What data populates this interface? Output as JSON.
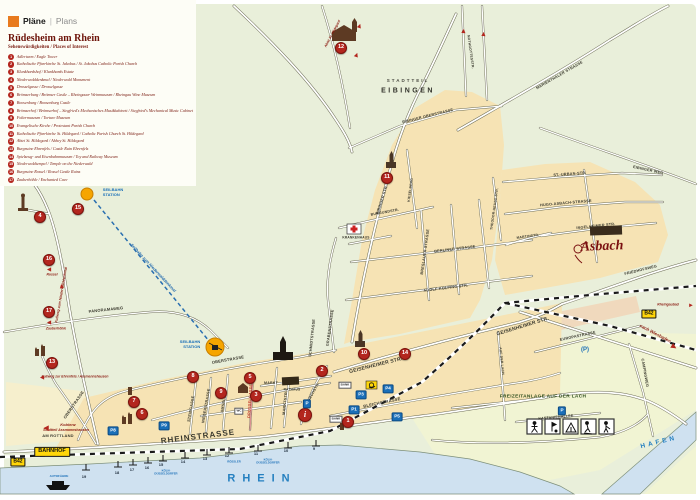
{
  "header": {
    "brand_de": "Pläne",
    "sep": "|",
    "brand_en": "Plans"
  },
  "legend": {
    "title": "Rüdesheim am Rhein",
    "subtitle": "Sehenswürdigkeiten / Places of Interest",
    "items": [
      {
        "num": "1",
        "label": "Adlerturm / Eagle Tower"
      },
      {
        "num": "2",
        "label": "Katholische Pfarrkirche St. Jakobus / St. Jakobus Catholic Parish Church"
      },
      {
        "num": "3",
        "label": "Klunkhardshof / Klunkhards Estate"
      },
      {
        "num": "4",
        "label": "Niederwalddenkmal / Niederwald Monument"
      },
      {
        "num": "5",
        "label": "Drosselgasse / Drosselgasse"
      },
      {
        "num": "6",
        "label": "Brömserburg / Brömser Castle – Rheingauer Weinmuseum / Rheingau Wine Museum"
      },
      {
        "num": "7",
        "label": "Boosenburg / Boosenburg Castle"
      },
      {
        "num": "8",
        "label": "Brömserhof / Brömserhof – Siegfried's Mechanisches Musikkabinett / Siegfried's Mechanical Music Cabinet"
      },
      {
        "num": "9",
        "label": "Foltermuseum / Torture Museum"
      },
      {
        "num": "10",
        "label": "Evangelische Kirche / Protestant Parish Church"
      },
      {
        "num": "11",
        "label": "Katholische Pfarrkirche St. Hildegard / Catholic Parish Church St. Hildegard"
      },
      {
        "num": "12",
        "label": "Abtei St. Hildegard / Abbey St. Hildegard"
      },
      {
        "num": "13",
        "label": "Burgruine Ehrenfels / Castle Ruin Ehrenfels"
      },
      {
        "num": "14",
        "label": "Spielzeug- und Eisenbahnmuseum / Toy and Railway Museum"
      },
      {
        "num": "15",
        "label": "Niederwaldtempel / Temple on the Niederwald"
      },
      {
        "num": "16",
        "label": "Burgruine Rossel / Rossel Castle Ruins"
      },
      {
        "num": "17",
        "label": "Zauberhöhle / Enchanted Cave"
      }
    ]
  },
  "map": {
    "district": {
      "line1": "STADTTEIL",
      "line2": "EIBINGEN"
    },
    "water": {
      "rhein": "RHEIN",
      "hafen": "HAFEN",
      "autofaehre": "AUTOFÄHRE"
    },
    "stations": {
      "seilbahn": "SEILBAHN\nSTATION"
    },
    "badges": {
      "bahnhof": "BAHNHOF",
      "b42": "B42",
      "markt": "MARKT",
      "rathaus": "RATHAUS",
      "krankenhaus": "KRANKENHAUS",
      "bank": "BANK",
      "wc": "WC",
      "asbach": "Asbach"
    },
    "freizeit": "FREIZEITANLAGE AUF DER LACH",
    "directions": {
      "koblenz1": "Koblenz",
      "koblenz2": "Stadtteil Assmannshausen",
      "wiesbaden": "nach Wiesbaden",
      "rheingaubad": "Rheingaubad",
      "rossel": "Rossel",
      "zauberhoehle": "Zauberhöhle",
      "ehrenfels": "Fußweg zur Ehrenfels / Assmannshausen",
      "fussweg": "Fußweg zum Niederwalddenkmal",
      "seilbahn": "Seilbahn zum Niederwalddenkmal",
      "abtei": "Abtei St. Hildegard"
    },
    "streets": [
      "RHEINSTRASSE",
      "AM ROTTLAND",
      "OBERSTRASSE",
      "OBERSTRASSE",
      "NIEDERSTRASSE",
      "STEINGASSE",
      "DROSSELGASSE",
      "AMSELSTR.",
      "MARKTSTR.",
      "SCHMIDTSTRASSE",
      "GRABENSTRASSE",
      "KIRCHSTR.",
      "GEISENHEIMER STR.",
      "GEISENHEIMER STR.",
      "BLEICHSTRASSE",
      "ADOLF-KOLPING-STR.",
      "BERLINER STRASSE",
      "BRESLAUER STRASSE",
      "EIBINGER STR.",
      "EIBINGER OBERSTRASSE",
      "MARIENTHALER STRASSE",
      "ST.-URBAN-STR.",
      "HUGO-ASBACH-STRASSE",
      "INGELHEIMER STR.",
      "EIBINGER WEG",
      "FRIEDHOFSWEG",
      "EUROPASTRASSE",
      "CAMPINGWEG",
      "KASTANIENALLEE",
      "PANORAMAWEG",
      "AUF DER LACH",
      "NOTHGOTTESSTR.",
      "BURGUNDSTR.",
      "KIESELBERG",
      "THEODOR-HEUSS-STR.",
      "MARTINSTR."
    ],
    "markers": [
      "1",
      "2",
      "3",
      "4",
      "5",
      "6",
      "7",
      "8",
      "9",
      "10",
      "11",
      "12",
      "13",
      "14",
      "15",
      "16",
      "17"
    ],
    "info": "i",
    "parking": [
      "P1",
      "P3",
      "P4",
      "P5",
      "P8",
      "P9",
      "P",
      "P",
      "(P)"
    ],
    "piers": [
      "19",
      "18",
      "17",
      "16",
      "15",
      "14",
      "13",
      "12",
      "11",
      "10",
      "9"
    ],
    "pier_companies": {
      "kd": "KÖLN-\nDÜSSELDORFER",
      "roessler": "RÖSSLER"
    }
  }
}
